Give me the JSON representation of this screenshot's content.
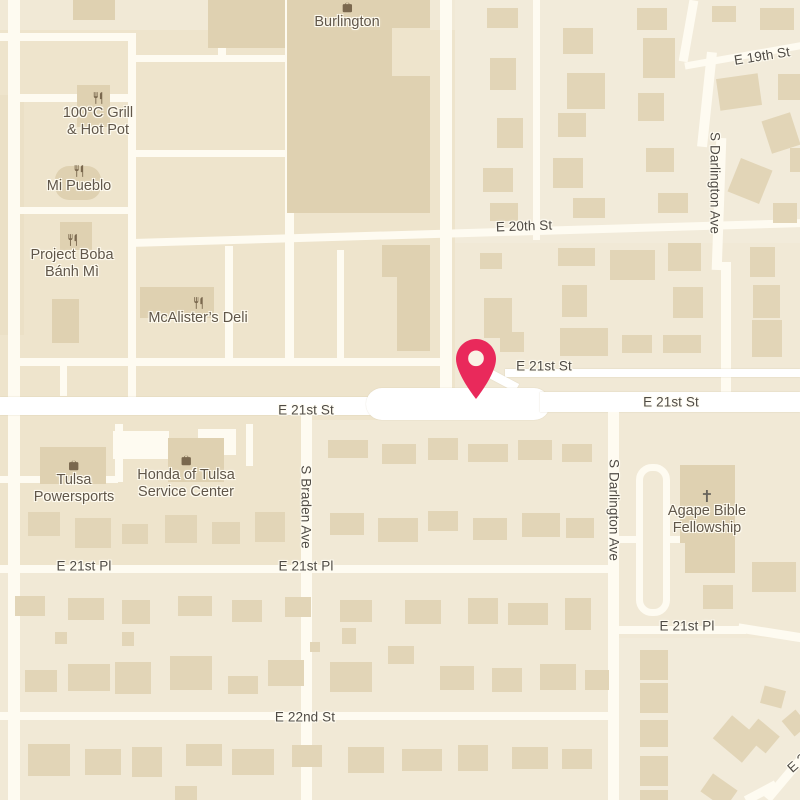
{
  "map": {
    "type": "street-map",
    "city_area": "Tulsa",
    "colors": {
      "base": "#F1E9D6",
      "commercial_block": "#EEE4CC",
      "light_block": "#F2EBDA",
      "dark_block": "#EBE0C6",
      "road": "#FEFBF1",
      "road_major": "#FFFFFF",
      "building": "#DFD1B1",
      "house": "#E2D5B7",
      "street_text": "#4F4B45",
      "poi_text": "#605649",
      "poi_icon": "#7A684E",
      "church_icon": "#68645C",
      "pin": "#E9295B",
      "pin_hole": "#FAF2E6",
      "halo": "#FFFCF2"
    }
  },
  "streets": [
    {
      "label": "E 19th St"
    },
    {
      "label": "E 20th St"
    },
    {
      "label": "E 21st St"
    },
    {
      "label": "E 21st St"
    },
    {
      "label": "E 21st St"
    },
    {
      "label": "S Darlington Ave"
    },
    {
      "label": "S Braden Ave"
    },
    {
      "label": "S Darlington Ave"
    },
    {
      "label": "E 21st Pl"
    },
    {
      "label": "E 21st Pl"
    },
    {
      "label": "E 21st Pl"
    },
    {
      "label": "E 22nd St"
    },
    {
      "label": "E 2"
    }
  ],
  "pois": [
    {
      "icon": "shopping-bag",
      "lines": [
        "Burlington"
      ]
    },
    {
      "icon": "restaurant",
      "lines": [
        "100°C Grill",
        "& Hot Pot"
      ]
    },
    {
      "icon": "restaurant",
      "lines": [
        "Mi Pueblo"
      ]
    },
    {
      "icon": "restaurant",
      "lines": [
        "Project Boba",
        "Bánh Mì"
      ]
    },
    {
      "icon": "restaurant",
      "lines": [
        "McAlister’s Deli"
      ]
    },
    {
      "icon": "shopping-bag",
      "lines": [
        "Tulsa",
        "Powersports"
      ]
    },
    {
      "icon": "shopping-bag",
      "lines": [
        "Honda of Tulsa",
        "Service Center"
      ]
    },
    {
      "icon": "church-cross",
      "lines": [
        "Agape Bible",
        "Fellowship"
      ]
    }
  ],
  "pin": {
    "name": "location-marker",
    "street": "E 21st St"
  }
}
